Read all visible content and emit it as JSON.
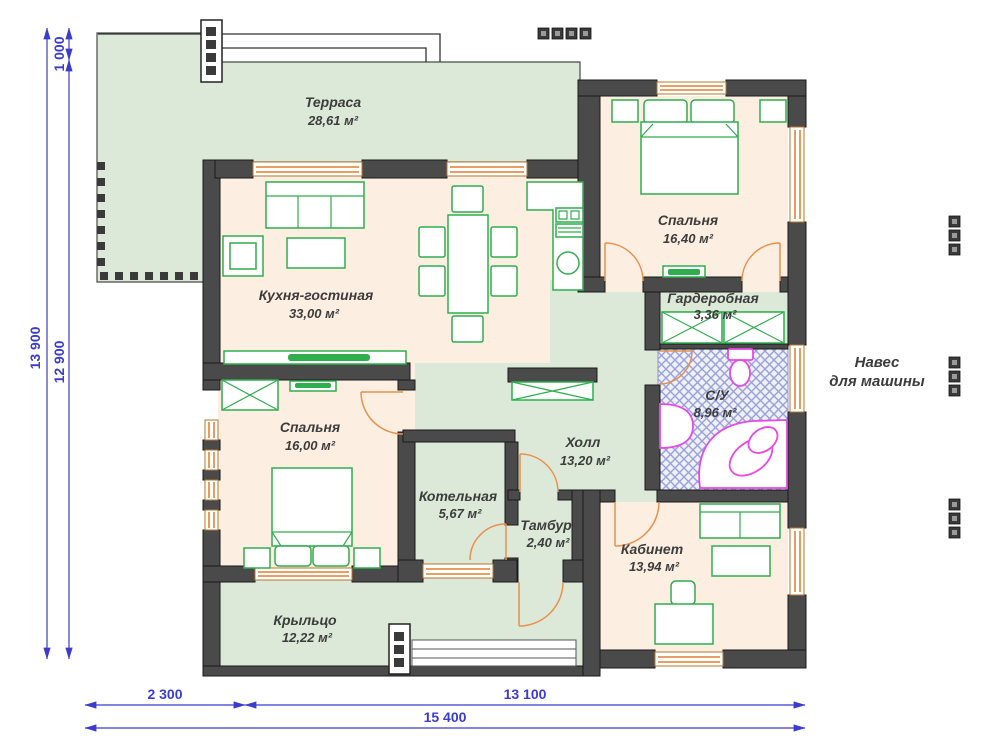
{
  "plan": {
    "rooms": [
      {
        "id": "terrace",
        "name": "Терраса",
        "area": "28,61 м²"
      },
      {
        "id": "kitchen",
        "name": "Кухня-гостиная",
        "area": "33,00 м²"
      },
      {
        "id": "bedroom1",
        "name": "Спальня",
        "area": "16,40 м²"
      },
      {
        "id": "wardrobe",
        "name": "Гардеробная",
        "area": "3,36 м²"
      },
      {
        "id": "bathroom",
        "name": "С/У",
        "area": "8,96 м²"
      },
      {
        "id": "hall",
        "name": "Холл",
        "area": "13,20 м²"
      },
      {
        "id": "bedroom2",
        "name": "Спальня",
        "area": "16,00 м²"
      },
      {
        "id": "boiler",
        "name": "Котельная",
        "area": "5,67 м²"
      },
      {
        "id": "vestibule",
        "name": "Тамбур",
        "area": "2,40 м²"
      },
      {
        "id": "office",
        "name": "Кабинет",
        "area": "13,94 м²"
      },
      {
        "id": "porch",
        "name": "Крыльцо",
        "area": "12,22 м²"
      }
    ],
    "carport": {
      "line1": "Навес",
      "line2": "для машины"
    },
    "dimensions": {
      "left_total": "13 900",
      "left_main": "12 900",
      "left_top": "1 000",
      "bottom_left": "2 300",
      "bottom_right": "13 100",
      "bottom_total": "15 400"
    },
    "colors": {
      "wall": "#4a4a4a",
      "room_warm": "#fcefe1",
      "room_cool": "#dce9d8",
      "window": "#e8914d",
      "furniture": "#2fae4e",
      "sanitary": "#e748e7",
      "dimension": "#3b3bd0",
      "text": "#3c3c3c",
      "hatch": "#9aa0d8"
    }
  }
}
